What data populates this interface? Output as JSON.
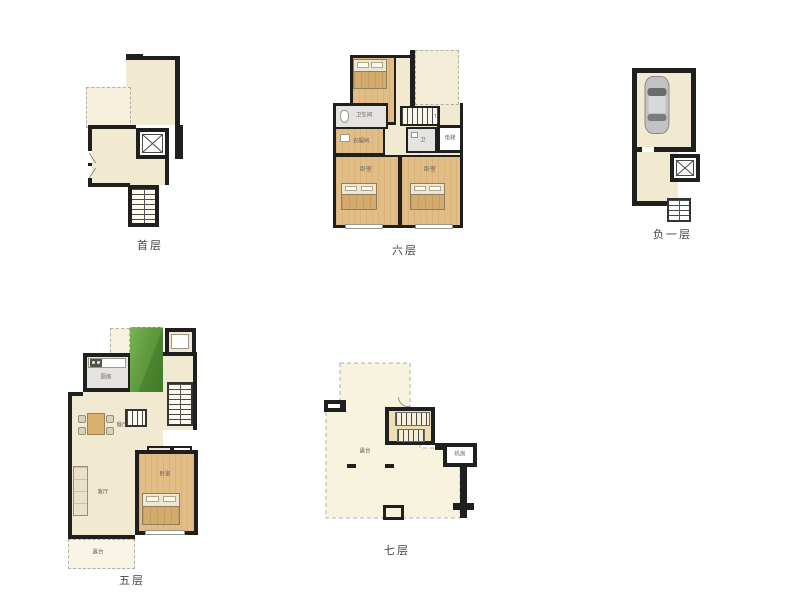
{
  "colors": {
    "wall": "#1f1f1f",
    "floor_cream": "#f2ead0",
    "floor_wood": "#e2bd85",
    "floor_gray": "#e4e3df",
    "terrace_pale": "#f8f3de",
    "garden_green": "#5f9c3e",
    "dashed_line": "#b0afa6"
  },
  "floors": {
    "first": {
      "label": "首层"
    },
    "sixth": {
      "label": "六层",
      "stairs_arrow": "↑",
      "rooms": {
        "bedroom_top": "卧室",
        "bathroom": "卫生间",
        "cloakroom": "衣帽间",
        "toilet": "卫",
        "elevator": "电梯",
        "bedroom_left": "卧室",
        "bedroom_right": "卧室"
      }
    },
    "basement": {
      "label": "负一层"
    },
    "fifth": {
      "label": "五层",
      "rooms": {
        "kitchen": "厨房",
        "dining": "餐厅",
        "toilet": "卫",
        "cloakroom": "衣帽",
        "living": "客厅",
        "bedroom": "卧室",
        "balcony": "露台"
      }
    },
    "seventh": {
      "label": "七层",
      "rooms": {
        "terrace": "露台",
        "machine_room": "机房"
      }
    }
  }
}
